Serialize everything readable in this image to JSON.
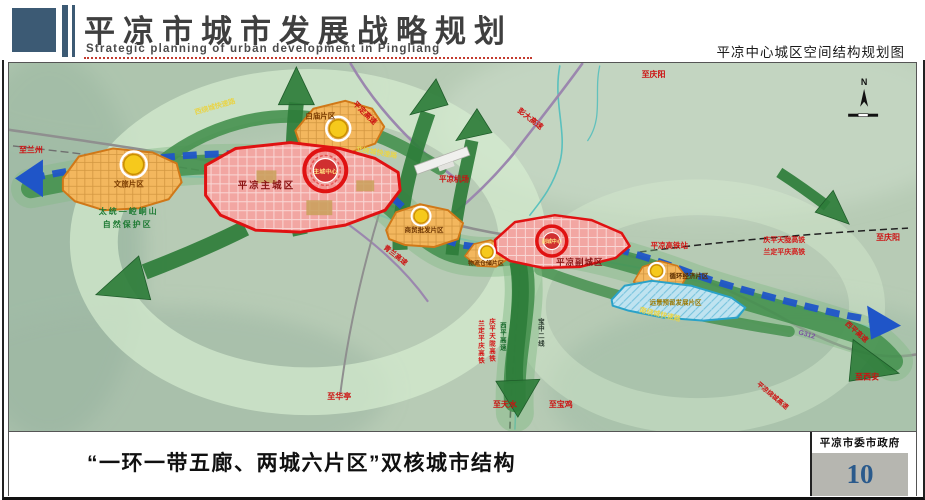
{
  "header": {
    "title_cn": "平凉市城市发展战略规划",
    "title_en": "Strategic planning of urban development in Pingliang",
    "caption_right": "平凉中心城区空间结构规划图"
  },
  "footer": {
    "slogan": "“一环一带五廊、两城六片区”双核城市结构",
    "agency": "平凉市委市政府",
    "page_number": "10"
  },
  "map": {
    "compass": "N",
    "labels": {
      "to_lanzhou": "至兰州",
      "to_qingyang_road": "至庆阳",
      "to_qingyang_rail": "至庆阳",
      "to_xian": "至西安",
      "to_tianshui": "至天水",
      "to_baoji": "至宝鸡",
      "to_huating": "至华亭",
      "west_ring": "西绕城快速路",
      "north_ring": "北绕城快速路",
      "south_ring": "南绕城快速路",
      "pingding_expwy": "平定高速",
      "pengda_expwy": "彭大高速",
      "qinglan_expwy": "青兰高速",
      "xiping_expwy": "西平高速",
      "raocheng_expwy": "平凉绕城高速",
      "g312": "G312",
      "airport": "平凉机场",
      "hsr_station": "平凉高铁站",
      "hsr_ne_1": "庆平天陇高铁",
      "hsr_ne_2": "兰定平庆高铁",
      "rail_s_1": "兰定平庆高铁",
      "rail_s_2": "庆平天陇高铁",
      "rail_s_3": "西平高速",
      "rail_s_4": "宝中二线",
      "reserve_1": "太统—崆峒山",
      "reserve_2": "自然保护区",
      "zone_baimiao": "白庙片区",
      "zone_wenlv": "文旅片区",
      "zone_shangmao": "商贸批发片区",
      "zone_wuliu": "物流仓储片区",
      "zone_xunhuan": "循环经济片区",
      "zone_yuanjing": "远景预留发展片区",
      "main_city": "平凉主城区",
      "main_center": "主城中心",
      "sub_city": "平凉副城区",
      "sub_center": "副城中心"
    },
    "colors": {
      "axis_blue": "#1f55c8",
      "corridor_green": "#2e7d3a",
      "zone_red_border": "#e01212",
      "district_orange": "#f3b75e",
      "reserved_blue": "#bfe3f0",
      "node_yellow": "#f6c91c"
    }
  }
}
